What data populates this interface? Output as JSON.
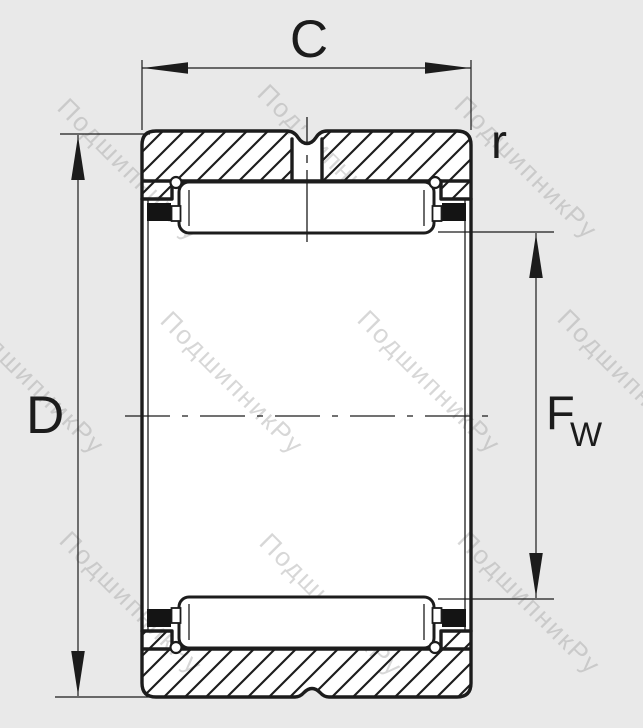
{
  "diagram": {
    "type": "bearing-cross-section",
    "description_visible_text_only": true,
    "labels": {
      "width_dim": "C",
      "outer_diameter_dim": "D",
      "corner_radius_dim": "r",
      "bore_diameter_main": "F",
      "bore_diameter_sub": "W"
    },
    "watermark": {
      "text": "ПодшипникРу"
    },
    "colors": {
      "background": "#e9e9e9",
      "line": "#1c1c1c",
      "part_fill": "#ffffff",
      "seal_fill": "#141414",
      "watermark": "#9e9e9e"
    }
  }
}
